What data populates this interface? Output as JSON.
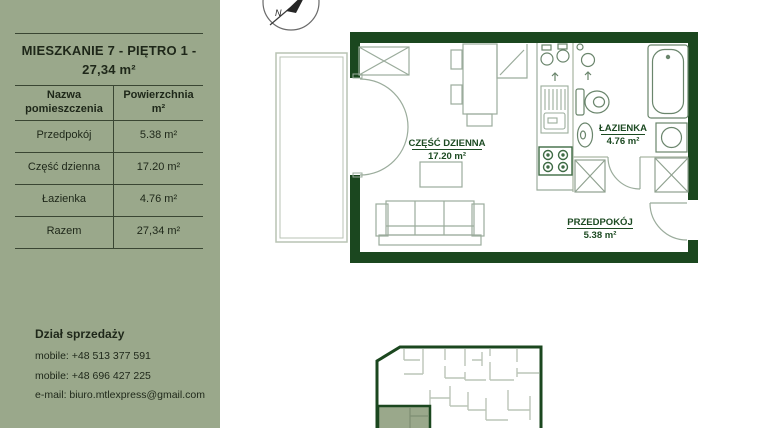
{
  "page": {
    "background": "#ffffff"
  },
  "sidebar": {
    "background_color": "#9AA88B",
    "text_color": "#1E2719",
    "title_line1": "MIESZKANIE 7 - PIĘTRO 1 -",
    "title_line2": "27,34 m²",
    "table": {
      "header_name": "Nazwa pomieszczenia",
      "header_area": "Powierzchnia m²",
      "rows": [
        {
          "name": "Przedpokój",
          "area": "5.38 m²"
        },
        {
          "name": "Część dzienna",
          "area": "17.20 m²"
        },
        {
          "name": "Łazienka",
          "area": "4.76 m²"
        },
        {
          "name": "Razem",
          "area": "27,34 m²"
        }
      ]
    },
    "contact": {
      "heading": "Dział sprzedaży",
      "lines": [
        "mobile: +48 513 377 591",
        "mobile: +48 696 427 225",
        "e-mail: biuro.mtlexpress@gmail.com"
      ]
    }
  },
  "floorplan": {
    "wall_color": "#1B471F",
    "furniture_color": "#9BAC9C",
    "fixture_color": "#6A856C",
    "label_color": "#1C4A22",
    "highlight_color": "#9AA88B",
    "compass": {
      "label": "N"
    },
    "rooms": [
      {
        "name": "CZĘŚĆ DZIENNA",
        "area": "17.20 m²"
      },
      {
        "name": "ŁAZIENKA",
        "area": "4.76 m²"
      },
      {
        "name": "PRZEDPOKÓJ",
        "area": "5.38 m²"
      }
    ]
  }
}
